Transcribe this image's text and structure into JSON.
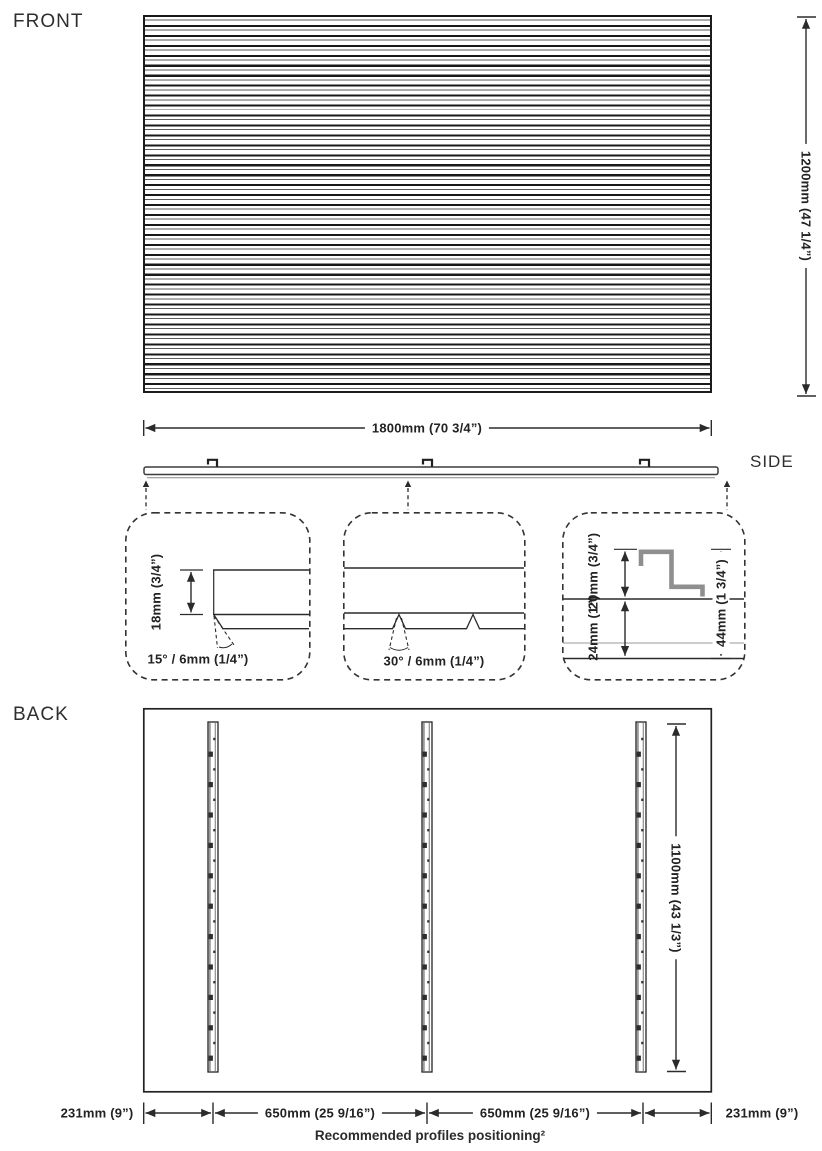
{
  "title_labels": {
    "front": "FRONT",
    "side": "SIDE",
    "back": "BACK"
  },
  "front_view": {
    "height_dim": "1200mm (47 1/4”)",
    "width_dim": "1800mm (70 3/4”)"
  },
  "side_view": {
    "detail_slat_edge": {
      "thickness_dim": "18mm (3/4”)",
      "chamfer_dim": "15° / 6mm (1/4”)"
    },
    "detail_slat_groove": {
      "groove_dim": "30° / 6mm (1/4”)"
    },
    "detail_mounting_clip": {
      "clip_dim": "20mm (3/4”)",
      "gap_dim": "24mm (1”)",
      "total_dim": "44mm (1 3/4”)"
    }
  },
  "back_view": {
    "profile_height_dim": "1100mm (43 1/3”)",
    "left_offset_dim": "231mm (9”)",
    "profile_spacing_dim_left": "650mm (25 9/16”)",
    "profile_spacing_dim_right": "650mm (25 9/16”)",
    "right_offset_dim": "231mm (9”)",
    "caption": "Recommended profiles positioning²"
  },
  "colors": {
    "line": "#2b2b2b",
    "profile_gray": "#8f8f8f",
    "background": "#ffffff"
  }
}
